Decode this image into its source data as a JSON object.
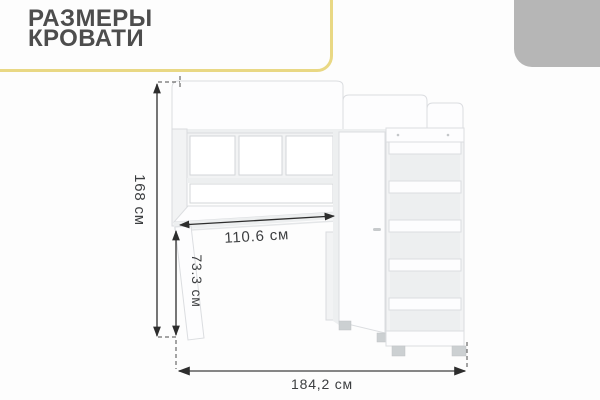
{
  "page": {
    "background": "#fdfdfd"
  },
  "header": {
    "title_line1": "РАЗМЕРЫ",
    "title_line2": "КРОВАТИ",
    "title_color": "#4d4d4d",
    "accent_frame_color": "#e9d884",
    "corner_tab_color": "#b6b6b6"
  },
  "diagram": {
    "subject": "loft-bed-with-desk-wardrobe-and-ladder",
    "line_color": "#2d2d2d",
    "label_color": "#3c3e40",
    "dimensions": {
      "overall_height": {
        "label": "168 см",
        "value_cm": 168,
        "orientation": "vertical-left"
      },
      "desk_width": {
        "label": "110.6 см",
        "value_cm": 110.6,
        "orientation": "diagonal-desk"
      },
      "desk_height": {
        "label": "73.3 см",
        "value_cm": 73.3,
        "orientation": "vertical-inner"
      },
      "overall_width": {
        "label": "184,2 см",
        "value_cm": 184.2,
        "orientation": "horizontal-bottom"
      }
    }
  }
}
